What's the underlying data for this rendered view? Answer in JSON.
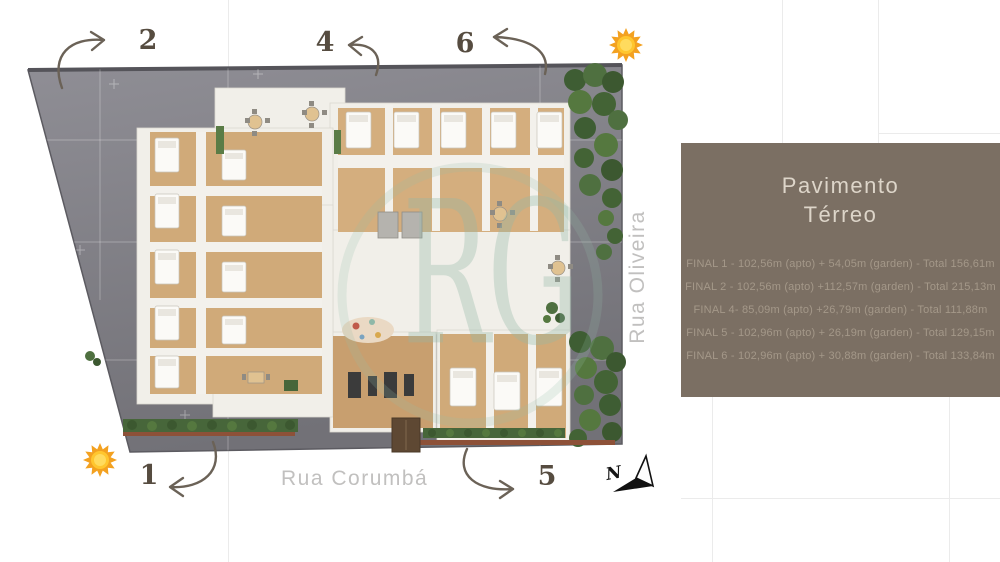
{
  "watermark": {
    "text": "RG"
  },
  "streets": {
    "bottom": "Rua Corumbá",
    "right": "Rua Oliveira"
  },
  "markers": [
    {
      "number": "2"
    },
    {
      "number": "4"
    },
    {
      "number": "6"
    },
    {
      "number": "1"
    },
    {
      "number": "5"
    }
  ],
  "panel": {
    "title_line1": "Pavimento",
    "title_line2": "Térreo",
    "units": [
      {
        "text": "FINAL 1 - 102,56m (apto) + 54,05m (garden) - Total 156,61m"
      },
      {
        "text": "FINAL 2 - 102,56m (apto) +112,57m (garden) - Total 215,13m"
      },
      {
        "text": "FINAL 4- 85,09m (apto) +26,79m (garden) - Total 111,88m"
      },
      {
        "text": "FINAL 5 - 102,96m (apto) + 26,19m (garden) - Total 129,15m"
      },
      {
        "text": "FINAL 6 - 102,96m (apto) + 30,88m (garden) - Total 133,84m"
      }
    ]
  },
  "icons": {
    "compass_letter": "N",
    "sun": "sun-icon",
    "compass": "compass-north-icon"
  },
  "colors": {
    "panel_bg": "#7b6f63",
    "panel_title": "#ddd5c9",
    "panel_text": "#a49889",
    "pavement": "#85848b",
    "wood_floor": "#d0aa79",
    "building": "#f1efe9",
    "greenery": "#4c6b3b",
    "street_label": "#c1c0bf",
    "marker_text": "#564c40",
    "arrow": "#6b6257",
    "sun_orange": "#f3a120",
    "sun_yellow": "#ffc62e"
  }
}
